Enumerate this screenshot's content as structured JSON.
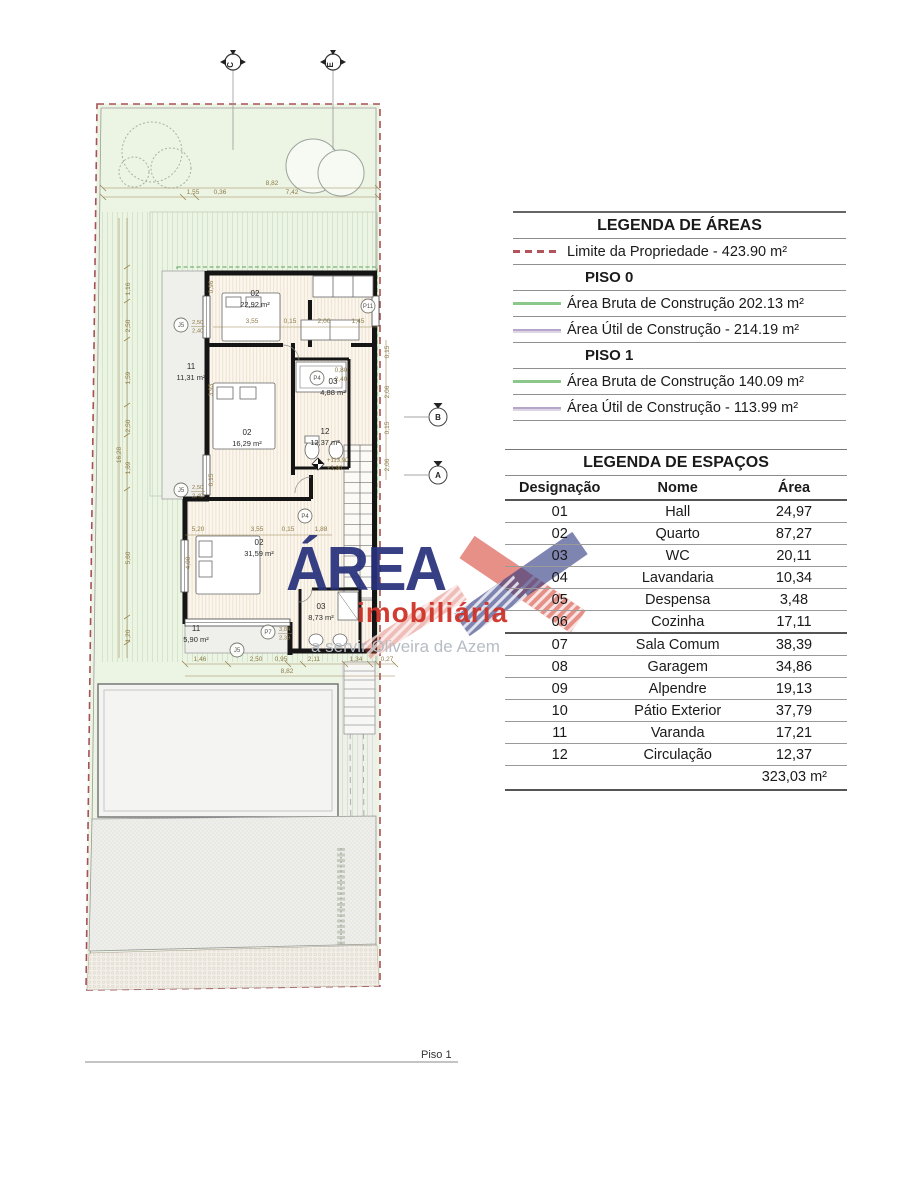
{
  "page": {
    "floor_label": "Piso 1"
  },
  "watermark": {
    "brand": "ÁREA",
    "subtitle": "imobiliária",
    "tagline": "a servir Oliveira de Azem",
    "brand_color": "#28317c",
    "accent_color": "#cf3328"
  },
  "legend_areas": {
    "title": "LEGENDA DE ÁREAS",
    "rows": [
      {
        "symbol": "dashed-red",
        "label": "Limite da Propriedade - 423.90 m²",
        "bold": false
      },
      {
        "symbol": "none",
        "label": "PISO 0",
        "bold": true
      },
      {
        "symbol": "line-green",
        "label": "Área Bruta de Construção 202.13 m²",
        "bold": false
      },
      {
        "symbol": "line-purple",
        "label": "Área Útil de Construção - 214.19 m²",
        "bold": false
      },
      {
        "symbol": "none",
        "label": "PISO 1",
        "bold": true
      },
      {
        "symbol": "line-green",
        "label": "Área Bruta de Construção 140.09 m²",
        "bold": false
      },
      {
        "symbol": "line-purple",
        "label": "Área Útil de Construção - 113.99 m²",
        "bold": false
      }
    ],
    "colors": {
      "boundary_red": "#b3545c",
      "gross_green": "#8cc88c",
      "net_purple": "#b5a6ca"
    }
  },
  "legend_spaces": {
    "title": "LEGENDA DE ESPAÇOS",
    "headers": [
      "Designação",
      "Nome",
      "Área"
    ],
    "rows": [
      [
        "01",
        "Hall",
        "24,97"
      ],
      [
        "02",
        "Quarto",
        "87,27"
      ],
      [
        "03",
        "WC",
        "20,11"
      ],
      [
        "04",
        "Lavandaria",
        "10,34"
      ],
      [
        "05",
        "Despensa",
        "3,48"
      ],
      [
        "06",
        "Cozinha",
        "17,11"
      ],
      [
        "07",
        "Sala Comum",
        "38,39"
      ],
      [
        "08",
        "Garagem",
        "34,86"
      ],
      [
        "09",
        "Alpendre",
        "19,13"
      ],
      [
        "10",
        "Pátio Exterior",
        "37,79"
      ],
      [
        "11",
        "Varanda",
        "17,21"
      ],
      [
        "12",
        "Circulação",
        "12,37"
      ]
    ],
    "total": "323,03 m²"
  },
  "plan": {
    "section_markers": [
      {
        "label": "C",
        "x": 233,
        "y": 62
      },
      {
        "label": "E",
        "x": 333,
        "y": 62
      }
    ],
    "elevation_markers": [
      {
        "label": "B",
        "x": 438,
        "y": 417
      },
      {
        "label": "A",
        "x": 438,
        "y": 475
      }
    ],
    "window_markers": [
      {
        "label": "J5",
        "x": 181,
        "y": 325,
        "dims": [
          "2,50",
          "2,40"
        ]
      },
      {
        "label": "J5",
        "x": 181,
        "y": 490,
        "dims": [
          "2,50",
          "2,40"
        ]
      },
      {
        "label": "P11",
        "x": 368,
        "y": 306,
        "dims": []
      },
      {
        "label": "P4",
        "x": 317,
        "y": 378,
        "dims": []
      },
      {
        "label": "P4",
        "x": 305,
        "y": 516,
        "dims": []
      },
      {
        "label": "P7",
        "x": 268,
        "y": 632,
        "dims": [
          "3,84",
          "2,39"
        ]
      },
      {
        "label": "J5",
        "x": 237,
        "y": 650,
        "dims": []
      }
    ],
    "rooms": [
      {
        "id": "02",
        "area": "22,92 m²",
        "x": 255,
        "y": 296
      },
      {
        "id": "11",
        "area": "11,31 m²",
        "x": 191,
        "y": 369
      },
      {
        "id": "02",
        "area": "16,29 m²",
        "x": 247,
        "y": 435
      },
      {
        "id": "03",
        "area": "4,88 m²",
        "x": 333,
        "y": 384
      },
      {
        "id": "12",
        "area": "12,37 m²",
        "x": 325,
        "y": 434
      },
      {
        "id": "02",
        "area": "31,59 m²",
        "x": 259,
        "y": 545
      },
      {
        "id": "03",
        "area": "8,73 m²",
        "x": 321,
        "y": 609
      },
      {
        "id": "11",
        "area": "5,90 m²",
        "x": 196,
        "y": 631
      }
    ],
    "level_marker": {
      "value": "+113,90",
      "relative": "+3,90",
      "x": 318,
      "y": 464
    },
    "dim_labels": [
      {
        "t": "8,82",
        "x": 272,
        "y": 185
      },
      {
        "t": "1,55",
        "x": 193,
        "y": 194
      },
      {
        "t": "0,36",
        "x": 220,
        "y": 194
      },
      {
        "t": "7,42",
        "x": 292,
        "y": 194
      },
      {
        "t": "1,16",
        "x": 130,
        "y": 289,
        "r": -90
      },
      {
        "t": "2,50",
        "x": 130,
        "y": 326,
        "r": -90
      },
      {
        "t": "1,59",
        "x": 130,
        "y": 378,
        "r": -90
      },
      {
        "t": "2,50",
        "x": 130,
        "y": 426,
        "r": -90
      },
      {
        "t": "1,69",
        "x": 130,
        "y": 468,
        "r": -90
      },
      {
        "t": "5,60",
        "x": 130,
        "y": 558,
        "r": -90
      },
      {
        "t": "1,20",
        "x": 130,
        "y": 636,
        "r": -90
      },
      {
        "t": "16,28",
        "x": 121,
        "y": 455,
        "r": -90
      },
      {
        "t": "3,55",
        "x": 252,
        "y": 323
      },
      {
        "t": "0,15",
        "x": 290,
        "y": 323
      },
      {
        "t": "2,00",
        "x": 324,
        "y": 323
      },
      {
        "t": "1,45",
        "x": 358,
        "y": 323
      },
      {
        "t": "5,20",
        "x": 198,
        "y": 531
      },
      {
        "t": "3,55",
        "x": 257,
        "y": 531
      },
      {
        "t": "0,15",
        "x": 288,
        "y": 531
      },
      {
        "t": "1,88",
        "x": 321,
        "y": 531
      },
      {
        "t": "1,46",
        "x": 200,
        "y": 661
      },
      {
        "t": "2,50",
        "x": 256,
        "y": 661
      },
      {
        "t": "0,95",
        "x": 281,
        "y": 661
      },
      {
        "t": "2,11",
        "x": 314,
        "y": 661
      },
      {
        "t": "1,34",
        "x": 356,
        "y": 661
      },
      {
        "t": "0,27",
        "x": 387,
        "y": 661
      },
      {
        "t": "8,82",
        "x": 287,
        "y": 673
      },
      {
        "t": "4,00",
        "x": 190,
        "y": 563,
        "r": -90
      },
      {
        "t": "0,80",
        "x": 341,
        "y": 372
      },
      {
        "t": "2,40",
        "x": 341,
        "y": 381
      },
      {
        "t": "0,15",
        "x": 389,
        "y": 352,
        "r": -90
      },
      {
        "t": "2,06",
        "x": 389,
        "y": 392,
        "r": -90
      },
      {
        "t": "0,15",
        "x": 389,
        "y": 428,
        "r": -90
      },
      {
        "t": "2,06",
        "x": 389,
        "y": 465,
        "r": -90
      },
      {
        "t": "0,96",
        "x": 213,
        "y": 287,
        "r": -90
      },
      {
        "t": "3,93",
        "x": 213,
        "y": 390,
        "r": -90
      },
      {
        "t": "0,15",
        "x": 213,
        "y": 480,
        "r": -90
      }
    ]
  }
}
